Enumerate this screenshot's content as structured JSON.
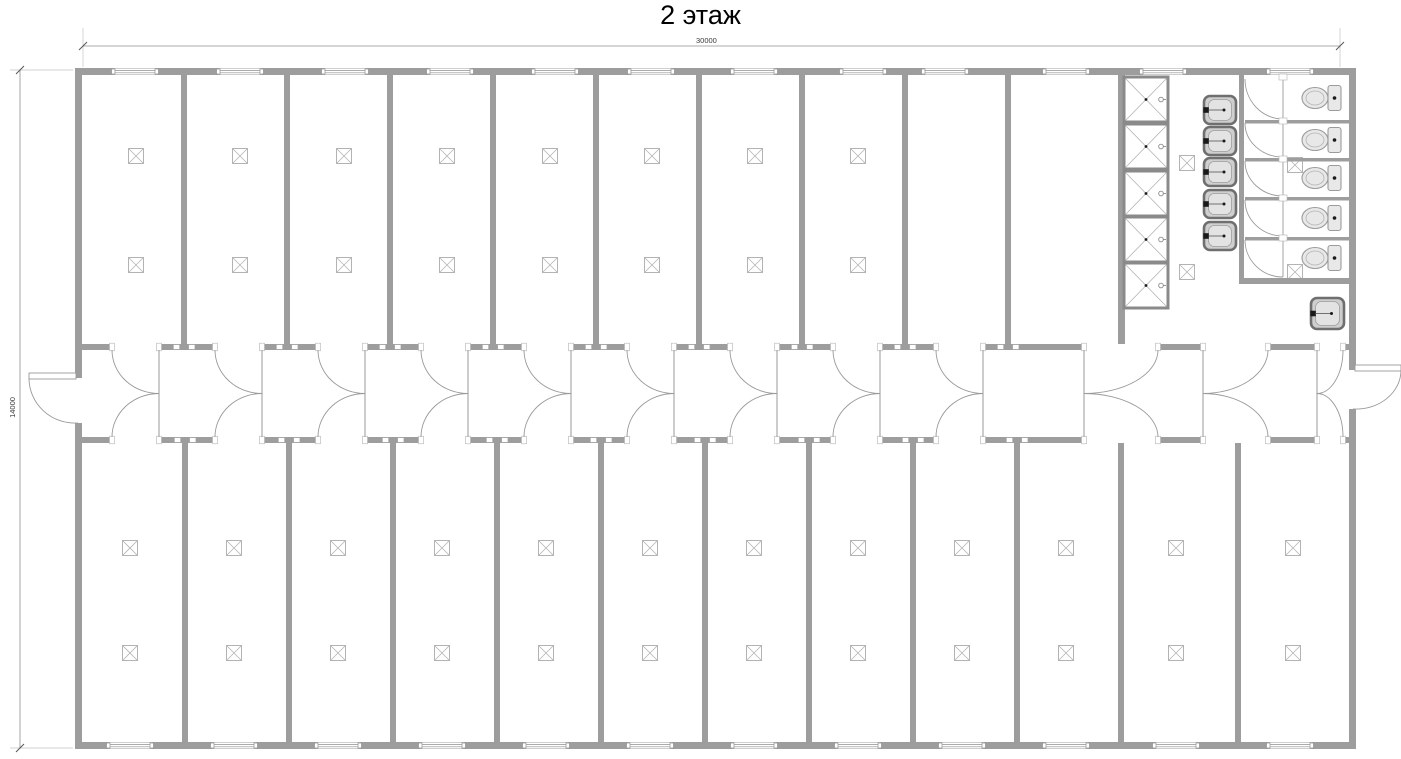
{
  "title": "2 этаж",
  "dimensions": {
    "width_label": "30000",
    "height_label": "14000"
  },
  "colors": {
    "wall": "#9d9d9d",
    "line": "#9a9a9a",
    "light_line": "#b3b3b3",
    "fixture_stroke": "#8a8a8a",
    "fixture_fill": "#ffffff",
    "basin_rim": "#6f6f6f",
    "basin_fill": "#cfcfcf",
    "basin_inner": "#e3e3e3",
    "toilet_fill": "#e8e8e8",
    "black": "#1a1a1a",
    "dim_line": "#8f8f8f",
    "ext_line": "#c2c2c2"
  },
  "plan": {
    "building": {
      "x": 75,
      "y": 68,
      "w": 1281,
      "h": 681,
      "wall": 7
    },
    "corridor": {
      "top_wall_y": 344,
      "bottom_wall_y": 437,
      "wall": 6
    },
    "top_band": {
      "dividers": [
        181,
        284,
        387,
        490,
        593,
        696,
        799,
        902,
        1005
      ],
      "sanitary_wall_x": 1118,
      "lamp_centers_x": [
        136,
        240,
        344,
        447,
        550,
        652,
        755,
        858
      ],
      "lamp_rows_y": [
        156,
        265
      ]
    },
    "bottom_band": {
      "dividers": [
        182,
        286,
        390,
        494,
        598,
        702,
        806,
        910,
        1014,
        1118,
        1235
      ],
      "lamp_centers_x": [
        130,
        234,
        338,
        442,
        546,
        650,
        754,
        858,
        962,
        1066,
        1176,
        1293
      ],
      "lamp_rows_y": [
        548,
        653
      ]
    },
    "windows": {
      "width": 44,
      "top_centers_x": [
        135,
        240,
        345,
        450,
        555,
        651,
        754,
        863,
        945,
        1066,
        1163,
        1290
      ],
      "bottom_centers_x": [
        130,
        234,
        338,
        442,
        546,
        650,
        754,
        858,
        962,
        1066,
        1176,
        1290
      ]
    },
    "door_modules": [
      {
        "o1": 112,
        "o2": 159,
        "hinge": "right"
      },
      {
        "o1": 215,
        "o2": 262,
        "hinge": "right"
      },
      {
        "o1": 318,
        "o2": 365,
        "hinge": "right"
      },
      {
        "o1": 421,
        "o2": 468,
        "hinge": "right"
      },
      {
        "o1": 524,
        "o2": 571,
        "hinge": "right"
      },
      {
        "o1": 627,
        "o2": 674,
        "hinge": "right"
      },
      {
        "o1": 730,
        "o2": 777,
        "hinge": "right"
      },
      {
        "o1": 833,
        "o2": 880,
        "hinge": "right"
      },
      {
        "o1": 936,
        "o2": 983,
        "hinge": "right"
      },
      {
        "o1": 1084,
        "o2": 1158,
        "hinge": "left"
      },
      {
        "o1": 1203,
        "o2": 1268,
        "hinge": "left"
      },
      {
        "o1": 1317,
        "o2": 1343,
        "hinge": "left"
      }
    ],
    "exterior_doors": {
      "left": {
        "y1": 378,
        "y2": 423
      },
      "right": {
        "y1": 370,
        "y2": 409
      }
    },
    "sanitary": {
      "showers": {
        "x": 1124,
        "w": 44,
        "h": 45,
        "ys": [
          77,
          124,
          171,
          217,
          263
        ]
      },
      "basins": {
        "x": 1204,
        "w": 32,
        "h": 28,
        "ys": [
          96,
          127,
          158,
          190,
          222
        ]
      },
      "aisle_wall": {
        "x": 1239,
        "w": 5,
        "y1": 75,
        "y2": 284
      },
      "stall_bottom_wall_y": 278,
      "stall_dividers_y": [
        120,
        158,
        197,
        237
      ],
      "stall_bounds_y": [
        76,
        120,
        158,
        197,
        237,
        278
      ],
      "stall_front_x": 1283,
      "stall_door_left_x": 1245,
      "toilets": {
        "cx": 1315,
        "cys": [
          98,
          140,
          178,
          218,
          258
        ]
      },
      "extra_sink": {
        "x": 1311,
        "y": 298,
        "w": 33,
        "h": 31
      },
      "lamps": [
        [
          1187,
          163
        ],
        [
          1187,
          272
        ],
        [
          1295,
          165
        ],
        [
          1295,
          272
        ]
      ]
    },
    "dim_top": {
      "y": 46,
      "x1": 83,
      "x2": 1340
    },
    "dim_left": {
      "x": 20,
      "y1": 70,
      "y2": 748
    }
  }
}
